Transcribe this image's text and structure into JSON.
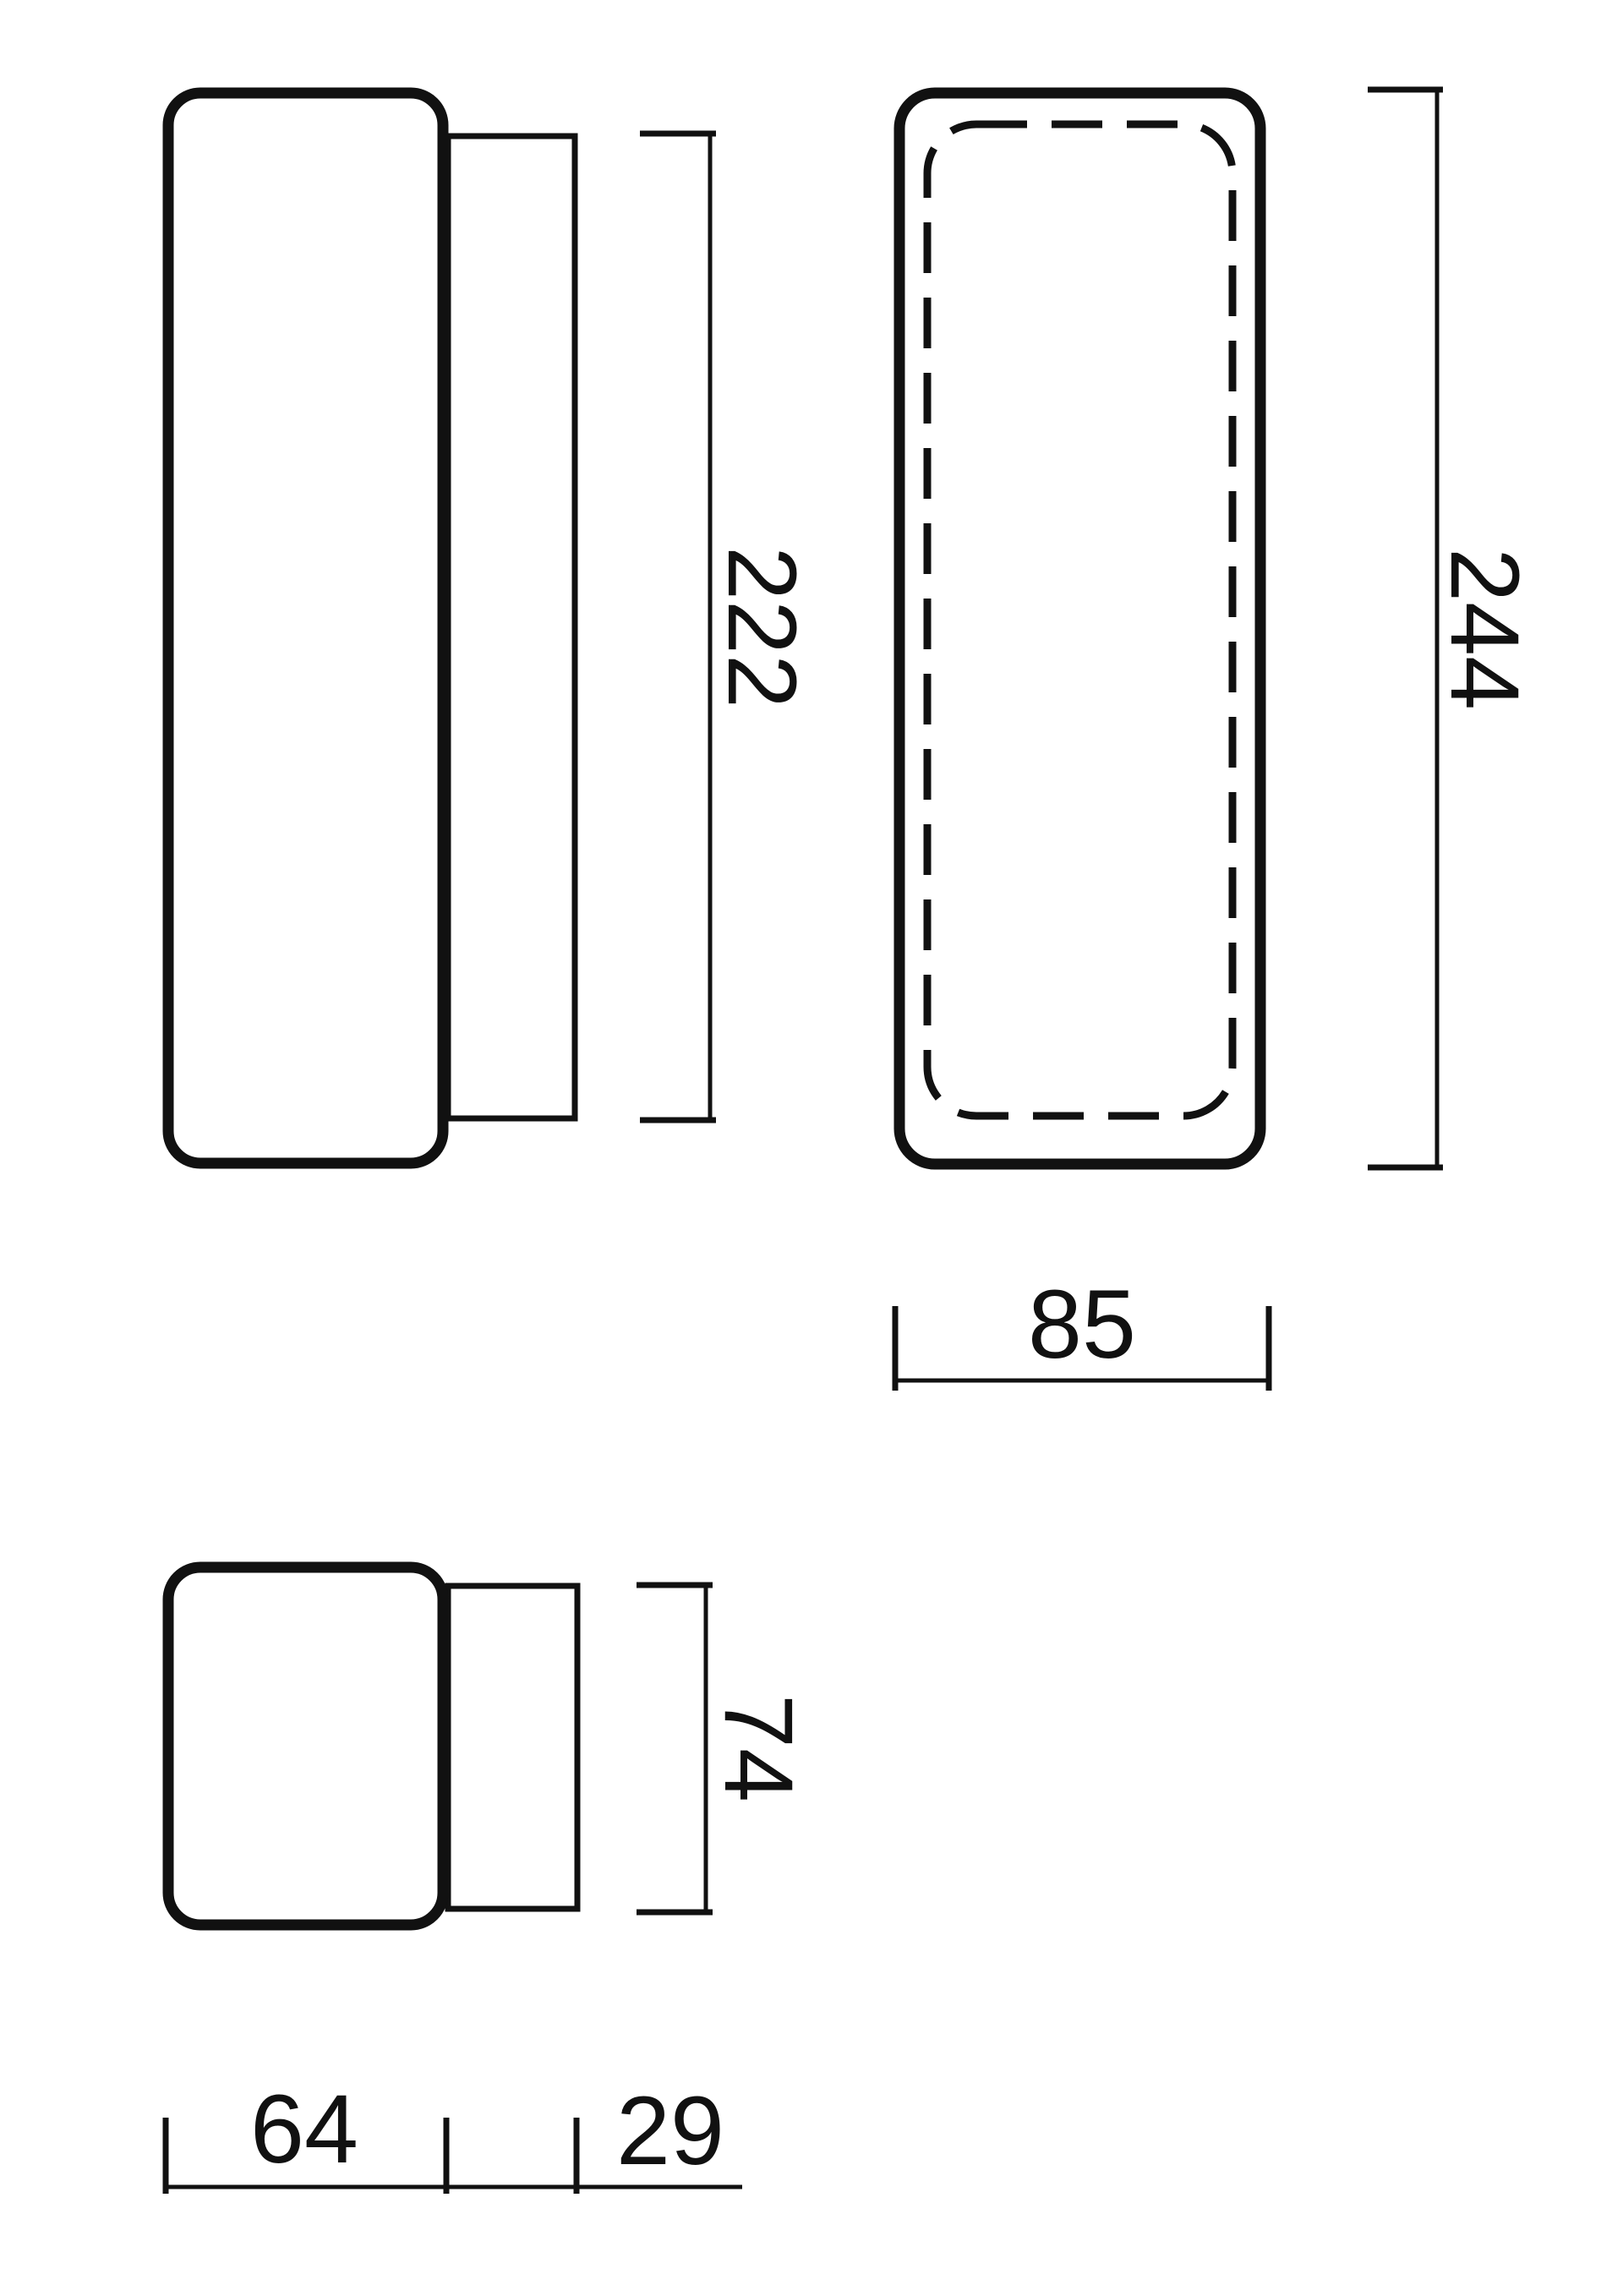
{
  "colors": {
    "line": "#111111",
    "background": "#ffffff"
  },
  "drawing": {
    "description": "Three-view dimensioned outline drawing of a rounded rectangular wall lamp with back mounting plate",
    "views": {
      "side_view": {
        "dimensions": {
          "backplate_height": "222"
        }
      },
      "front_view": {
        "dimensions": {
          "overall_height": "244",
          "overall_width": "85"
        }
      },
      "top_view": {
        "dimensions": {
          "body_width": "74",
          "body_depth": "64",
          "backplate_depth": "29"
        }
      }
    }
  }
}
